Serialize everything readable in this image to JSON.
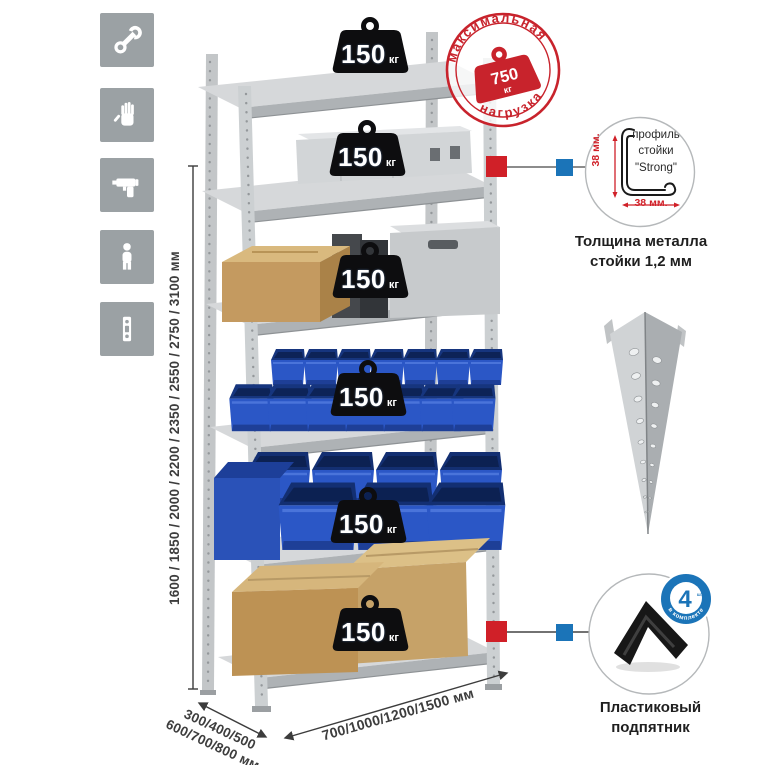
{
  "sidebar": {
    "icons": [
      {
        "name": "wrench-icon"
      },
      {
        "name": "gloves-icon"
      },
      {
        "name": "drill-icon"
      },
      {
        "name": "person-icon"
      },
      {
        "name": "perforated-post-icon"
      }
    ]
  },
  "rack": {
    "shelves": [
      {
        "load": "150",
        "unit": "кг"
      },
      {
        "load": "150",
        "unit": "кг"
      },
      {
        "load": "150",
        "unit": "кг"
      },
      {
        "load": "150",
        "unit": "кг"
      },
      {
        "load": "150",
        "unit": "кг"
      },
      {
        "load": "150",
        "unit": "кг"
      }
    ],
    "dimensions": {
      "height": "1600 / 1850 / 2000 / 2200 / 2350 / 2550 / 2750 / 3100 мм",
      "depth": "300/400/500\n600/700/800 мм",
      "width": "700/1000/1200/1500 мм"
    }
  },
  "stamp": {
    "arc_top": "максимальная",
    "arc_bottom": "нагрузка",
    "value": "750",
    "unit": "кг"
  },
  "details": {
    "profile": {
      "label": "профиль\nстойки\n\"Strong\"",
      "dim_vertical": "38 мм.",
      "dim_horizontal": "38 мм.",
      "caption": "Толщина металла\nстойки 1,2 мм"
    },
    "foot": {
      "caption": "Пластиковый\nподпятник",
      "badge_count": "4",
      "badge_count_unit": "штуки",
      "badge_arc": "в комплекте"
    }
  },
  "colors": {
    "accent_red": "#c8232c",
    "marker_red": "#d02028",
    "marker_blue": "#1b74b8",
    "bin_blue": "#2b57c6",
    "metal_gray": "#c9ccce",
    "tile_gray": "#9ba1a4"
  }
}
